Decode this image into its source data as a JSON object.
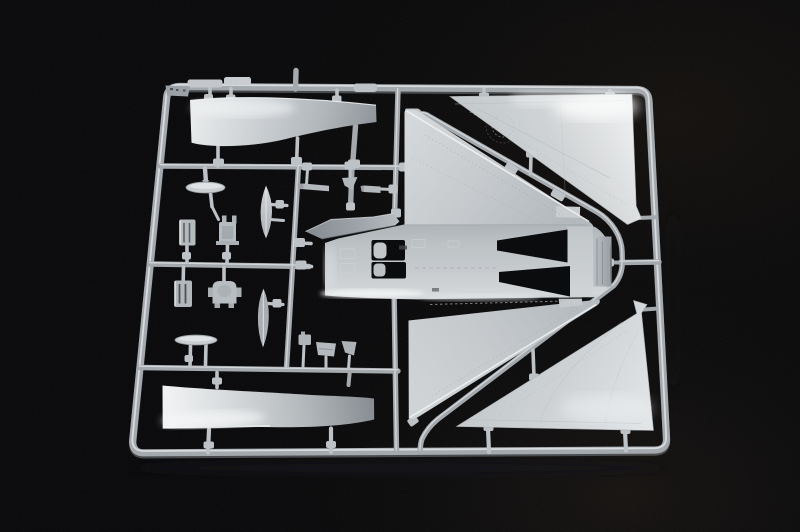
{
  "scene": {
    "title": "Injection-molded model kit sprue of a delta-wing jet aircraft",
    "description": "Photograph of a light gray styrene sprue frame on a black background containing aircraft model parts: two large triangular delta-wing skins on the right, a fuselage underside with wing roots in the center, two long curved outer wing panels on the left, and small fittings (gear doors, hatches, seat blocks, fin blades) connected by runners and gates."
  },
  "colors": {
    "bg": "#070709",
    "runner": "#a4a9ad",
    "runnerHi": "#dde0e3",
    "runnerLo": "#6a6e72",
    "part": "#c7cbce",
    "partHi": "#eceeef",
    "partLo": "#8f959a",
    "slot": "#0b0c0e",
    "canopy": "#9ba1a7",
    "gate": "#bdc2c6"
  },
  "sprue": {
    "frame": "rounded rectangular runner frame, slightly keystoned by camera perspective",
    "material": "light gray styrene plastic",
    "background": "matte black"
  },
  "parts": [
    {
      "id": "outer-wing-panel-upper",
      "label": "long curved outer wing panel, top left"
    },
    {
      "id": "outer-wing-panel-lower",
      "label": "long curved outer wing panel, bottom left"
    },
    {
      "id": "wing-skin-upper",
      "label": "large triangular delta-wing skin, upper right, notched tip"
    },
    {
      "id": "wing-skin-lower",
      "label": "large triangular delta-wing skin, lower right, notched tip"
    },
    {
      "id": "fuselage-belly",
      "label": "fuselage underside with wing roots, cockpit openings and engine nozzle"
    },
    {
      "id": "canopy-spine",
      "label": "canopy / spine wedge on fuselage nose"
    },
    {
      "id": "gear-door-oval-1",
      "label": "oval landing-gear door on support stalks"
    },
    {
      "id": "gear-door-oval-2",
      "label": "oval landing-gear door on support stalks"
    },
    {
      "id": "ribbed-hatch-1",
      "label": "small ribbed hatch panel"
    },
    {
      "id": "ribbed-hatch-2",
      "label": "small ribbed hatch panel"
    },
    {
      "id": "seat-block-1",
      "label": "small bracket / seat block"
    },
    {
      "id": "seat-block-2",
      "label": "small rounded seat block"
    },
    {
      "id": "fin-blade-1",
      "label": "vertical lens-shaped fin half"
    },
    {
      "id": "fin-blade-2",
      "label": "vertical lens-shaped fin half"
    },
    {
      "id": "small-fittings",
      "label": "assorted small pylons and fittings"
    },
    {
      "id": "runner-grid",
      "label": "internal runners, diagonal runner loop and sprue gates"
    }
  ]
}
